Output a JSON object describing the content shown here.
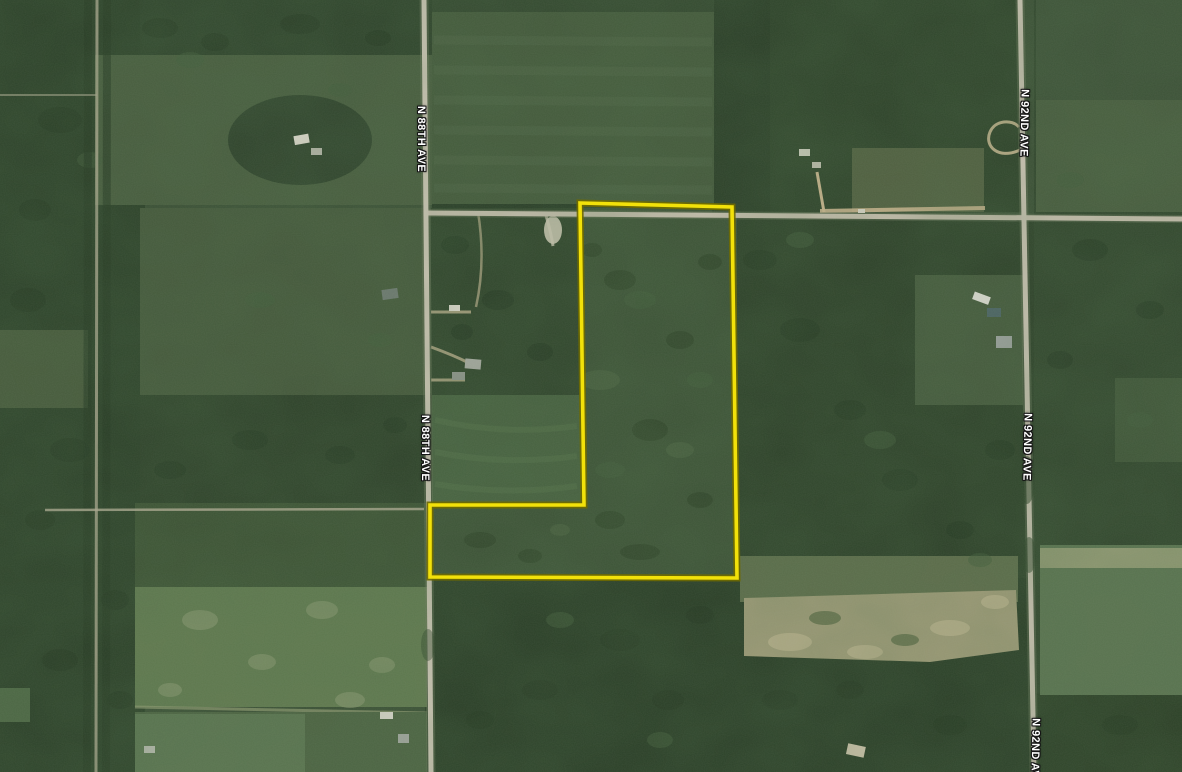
{
  "map": {
    "road_labels": [
      {
        "road": "n-88th-ave",
        "text": "N 88TH AVE"
      },
      {
        "road": "n-88th-ave",
        "text": "N 88TH AVE"
      },
      {
        "road": "n-92nd-ave",
        "text": "N 92ND AVE"
      },
      {
        "road": "n-92nd-ave",
        "text": "N 92ND AVE"
      },
      {
        "road": "n-92nd-ave",
        "text": "N 92ND AVE"
      }
    ]
  },
  "parcel": {
    "points": "580,203 732,207 737,578 430,577 430,505 584,505",
    "stroke_color": "#f2e10a",
    "outline_color": "#6f6a00"
  },
  "palette": {
    "base_green": "#3a4f35",
    "forest_green": "#2c4129",
    "field_green": "#60794f",
    "road_gray": "#cbc4b4",
    "sand_tan": "#9d9a77",
    "label_text": "#ffffff"
  }
}
